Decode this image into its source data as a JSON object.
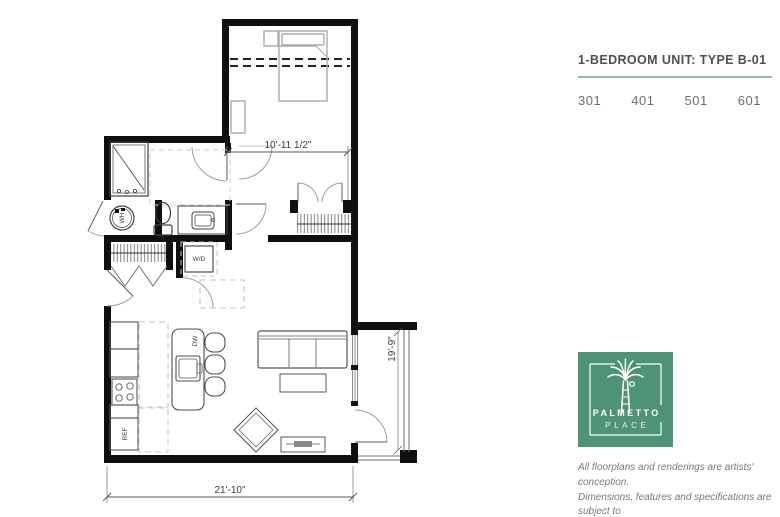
{
  "panel": {
    "title": "1-BEDROOM UNIT: TYPE B-01",
    "units": [
      "301",
      "401",
      "501",
      "601"
    ],
    "logo": {
      "line1": "PALMETTO",
      "line2": "PLACE"
    },
    "disclaimer_lines": [
      "All floorplans and renderings are artists' conception.",
      "Dimensions, features and specifications are subject to",
      "change at the discretion of the builder."
    ]
  },
  "floorplan": {
    "dimensions": {
      "bedroom_width": "10'-11 1/2\"",
      "overall_width": "21'-10\"",
      "balcony_depth": "19'-9\""
    },
    "labels": {
      "washer_dryer": "W/D",
      "refrigerator": "REF",
      "dishwasher": "DW",
      "water_heater": "WH"
    }
  },
  "colors": {
    "brand_green": "#4e9377",
    "rule_teal": "#8cbfa9",
    "title_gray": "#4a5055",
    "number_gray": "#6b7175",
    "disclaimer_gray": "#75797d",
    "wall_black": "#0f0f0f"
  }
}
